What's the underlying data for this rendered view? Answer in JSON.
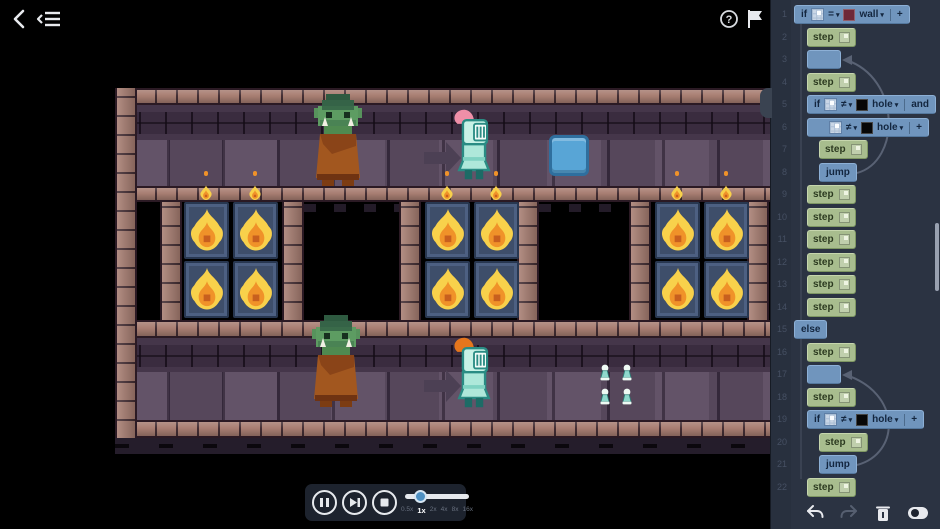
{
  "topbar": {
    "back_icon": "back-chevron",
    "menu_icon": "collapse-menu",
    "help_icon": "question-mark-circle",
    "flag_icon": "level-flag"
  },
  "code": {
    "line_numbers": [
      1,
      2,
      3,
      4,
      5,
      6,
      7,
      8,
      9,
      10,
      11,
      12,
      13,
      14,
      15,
      16,
      17,
      18,
      19,
      20,
      21,
      22
    ],
    "rows": [
      {
        "kind": "if",
        "indent": 0,
        "keyword": "if",
        "op": "=",
        "swatch": "wall",
        "swatch_color": "#6e2838",
        "value": "wall",
        "tail": "+"
      },
      {
        "kind": "step",
        "indent": 1,
        "label": "step"
      },
      {
        "kind": "empty",
        "indent": 1
      },
      {
        "kind": "step",
        "indent": 1,
        "label": "step"
      },
      {
        "kind": "if",
        "indent": 1,
        "keyword": "if",
        "op": "≠",
        "swatch": "hole",
        "swatch_color": "#070707",
        "value": "hole",
        "tail": "and"
      },
      {
        "kind": "cond",
        "indent": 1,
        "op": "≠",
        "swatch": "hole",
        "swatch_color": "#070707",
        "value": "hole",
        "tail": "+"
      },
      {
        "kind": "step",
        "indent": 2,
        "label": "step"
      },
      {
        "kind": "jump",
        "indent": 2,
        "label": "jump"
      },
      {
        "kind": "step",
        "indent": 1,
        "label": "step"
      },
      {
        "kind": "step",
        "indent": 1,
        "label": "step"
      },
      {
        "kind": "step",
        "indent": 1,
        "label": "step"
      },
      {
        "kind": "step",
        "indent": 1,
        "label": "step"
      },
      {
        "kind": "step",
        "indent": 1,
        "label": "step"
      },
      {
        "kind": "step",
        "indent": 1,
        "label": "step"
      },
      {
        "kind": "else",
        "indent": 0,
        "label": "else"
      },
      {
        "kind": "step",
        "indent": 1,
        "label": "step"
      },
      {
        "kind": "empty",
        "indent": 1
      },
      {
        "kind": "step",
        "indent": 1,
        "label": "step"
      },
      {
        "kind": "if",
        "indent": 1,
        "keyword": "if",
        "op": "≠",
        "swatch": "hole",
        "swatch_color": "#070707",
        "value": "hole",
        "tail": "+"
      },
      {
        "kind": "step",
        "indent": 2,
        "label": "step"
      },
      {
        "kind": "jump",
        "indent": 2,
        "label": "jump"
      },
      {
        "kind": "step",
        "indent": 1,
        "label": "step"
      }
    ],
    "loop_arrows": [
      {
        "from": 8,
        "to": 3
      },
      {
        "from": 21,
        "to": 17
      }
    ],
    "toolbar": {
      "undo_icon": "undo-arrow",
      "redo_icon": "redo-arrow",
      "delete_icon": "trash-can",
      "toggle_icon": "toggle-switch"
    },
    "colors": {
      "action_block": "#a8bd8e",
      "control_block": "#7095bd",
      "wall_swatch": "#6e2838",
      "hole_swatch": "#070707"
    }
  },
  "playback": {
    "pause_icon": "pause",
    "step_icon": "step-forward",
    "stop_icon": "stop",
    "speeds": [
      "0.5x",
      "1x",
      "2x",
      "4x",
      "8x",
      "16x"
    ],
    "active_speed": "1x"
  },
  "scene": {
    "entities": [
      "goblin",
      "knight",
      "direction-arrow",
      "push-block",
      "fire-brazier",
      "torch-flame",
      "pawn-markers"
    ],
    "knight_top_plume": "#ef8fa8",
    "knight_bottom_plume": "#e5761d",
    "push_block_color": "#58a5d6",
    "fire_color": "#f8d14b",
    "brick_color": "#a87e72"
  }
}
